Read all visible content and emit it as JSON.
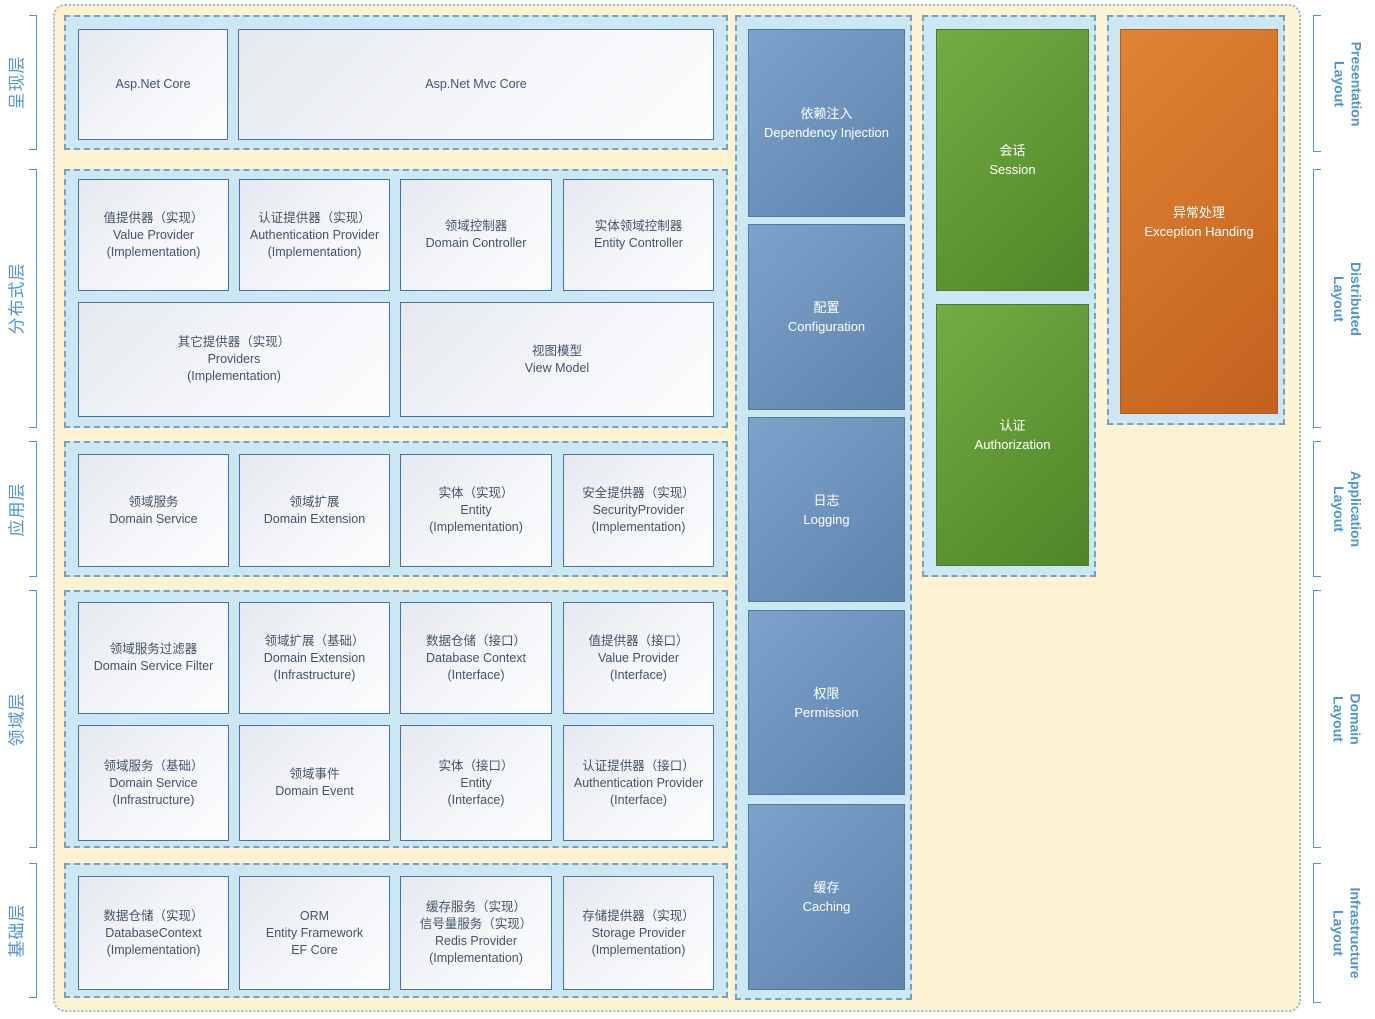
{
  "colors": {
    "accent": "#4f96d5",
    "canvas_fill": "#fdf2d2",
    "canvas_dot": "#9db9d3",
    "band_fill": "#cbe7f4",
    "band_dash": "#7aa0bb",
    "node_border": "#49729f",
    "node_text": "#44546a",
    "service_box": "#6b93c0",
    "security_box": "#5f9a3c",
    "exception_box": "#cd6c29"
  },
  "left_labels": [
    {
      "label": "呈现层"
    },
    {
      "label": "分布式层"
    },
    {
      "label": "应用层"
    },
    {
      "label": "领域层"
    },
    {
      "label": "基础层"
    }
  ],
  "right_labels": [
    {
      "line1": "Presentation",
      "line2": "Layout"
    },
    {
      "line1": "Distributed",
      "line2": "Layout"
    },
    {
      "line1": "Application",
      "line2": "Layout"
    },
    {
      "line1": "Domain",
      "line2": "Layout"
    },
    {
      "line1": "Infrastructure",
      "line2": "Layout"
    }
  ],
  "presentation": {
    "boxes": [
      {
        "text": "Asp.Net Core"
      },
      {
        "text": "Asp.Net Mvc Core"
      }
    ]
  },
  "distributed": {
    "row1": [
      {
        "text": "值提供器（实现）\nValue Provider\n(Implementation)"
      },
      {
        "text": "认证提供器（实现）\nAuthentication Provider\n(Implementation)"
      },
      {
        "text": "领域控制器\nDomain Controller"
      },
      {
        "text": "实体领域控制器\nEntity Controller"
      }
    ],
    "row2": [
      {
        "text": "其它提供器（实现）\nProviders\n(Implementation)"
      },
      {
        "text": "视图模型\nView Model"
      }
    ]
  },
  "application": {
    "boxes": [
      {
        "text": "领域服务\nDomain Service"
      },
      {
        "text": "领域扩展\nDomain Extension"
      },
      {
        "text": "实体（实现）\nEntity\n(Implementation)"
      },
      {
        "text": "安全提供器（实现）\nSecurityProvider\n(Implementation)"
      }
    ]
  },
  "domain": {
    "row1": [
      {
        "text": "领域服务过滤器\nDomain Service Filter"
      },
      {
        "text": "领域扩展（基础）\nDomain Extension\n(Infrastructure)"
      },
      {
        "text": "数据仓储（接口）\nDatabase Context\n(Interface)"
      },
      {
        "text": "值提供器（接口）\nValue Provider\n(Interface)"
      }
    ],
    "row2": [
      {
        "text": "领域服务（基础）\nDomain Service\n(Infrastructure)"
      },
      {
        "text": "领域事件\nDomain Event"
      },
      {
        "text": "实体（接口）\nEntity\n(Interface)"
      },
      {
        "text": "认证提供器（接口）\nAuthentication Provider\n(Interface)"
      }
    ]
  },
  "infrastructure": {
    "boxes": [
      {
        "text": "数据仓储（实现）\nDatabaseContext\n(Implementation)"
      },
      {
        "text": "ORM\nEntity Framework\nEF Core"
      },
      {
        "text": "缓存服务（实现）\n信号量服务（实现）\nRedis Provider\n(Implementation)"
      },
      {
        "text": "存储提供器（实现）\nStorage Provider\n(Implementation)"
      }
    ]
  },
  "services": [
    {
      "text": "依赖注入\nDependency Injection"
    },
    {
      "text": "配置\nConfiguration"
    },
    {
      "text": "日志\nLogging"
    },
    {
      "text": "权限\nPermission"
    },
    {
      "text": "缓存\nCaching"
    }
  ],
  "security": [
    {
      "text": "会话\nSession"
    },
    {
      "text": "认证\nAuthorization"
    }
  ],
  "exception": {
    "text": "异常处理\nException Handing"
  }
}
